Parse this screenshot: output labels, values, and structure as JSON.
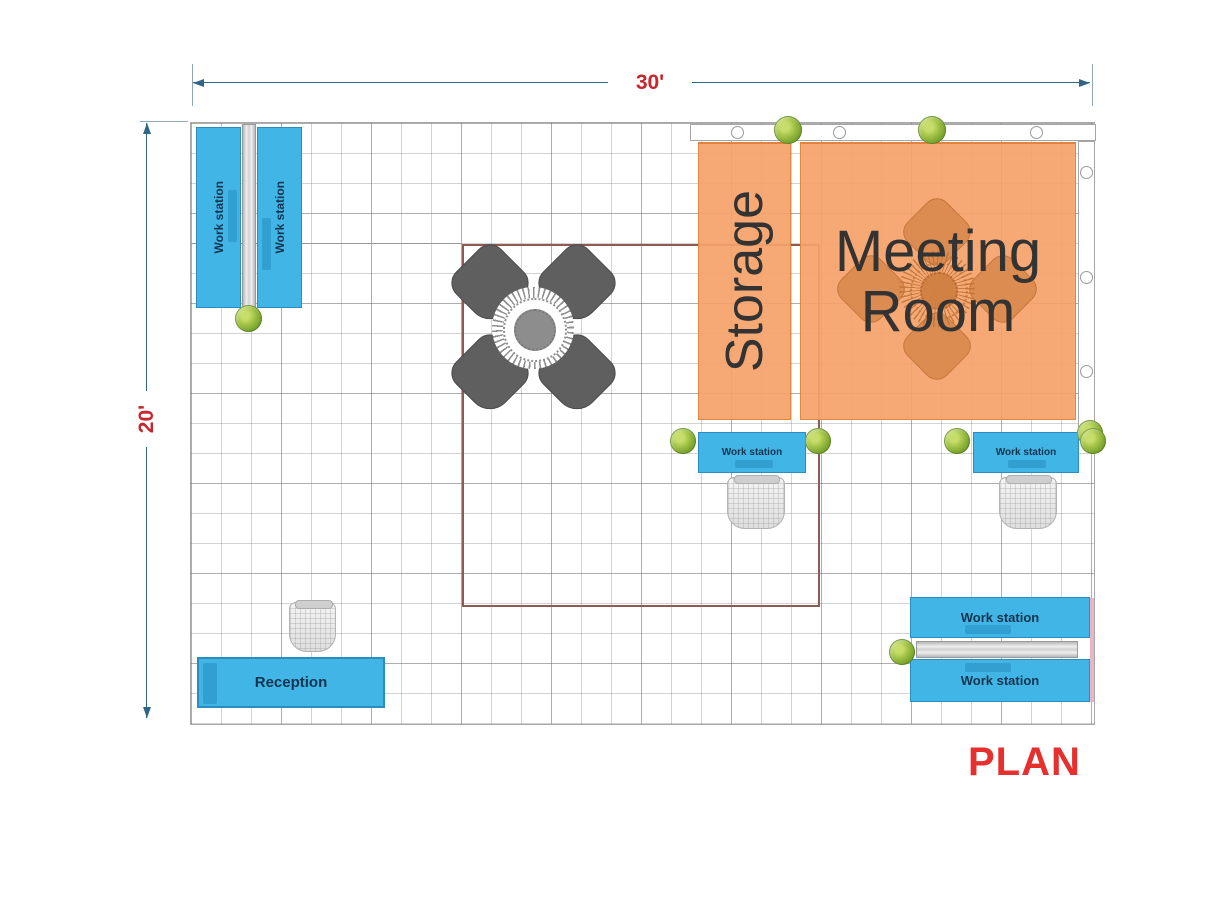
{
  "page": {
    "title_label": "PLAN"
  },
  "dimensions": {
    "width": "30'",
    "height": "20'"
  },
  "rooms": {
    "storage": "Storage",
    "meeting_room": "Meeting Room"
  },
  "labels": {
    "workstation": "Work station",
    "reception": "Reception"
  },
  "colors": {
    "workstation_fill": "#41b6e6",
    "workstation_border": "#2b8cbf",
    "room_fill": "rgba(245,163,106,0.93)",
    "room_border": "#e0883f",
    "inner_room_border": "#8e5b50",
    "dimension_line": "#2f6687",
    "dimension_text": "#c9252d",
    "plan_title": "#e5302e",
    "label_text": "#13344f",
    "room_label_text": "#333333",
    "dark_chair": "#5f5f5f"
  }
}
